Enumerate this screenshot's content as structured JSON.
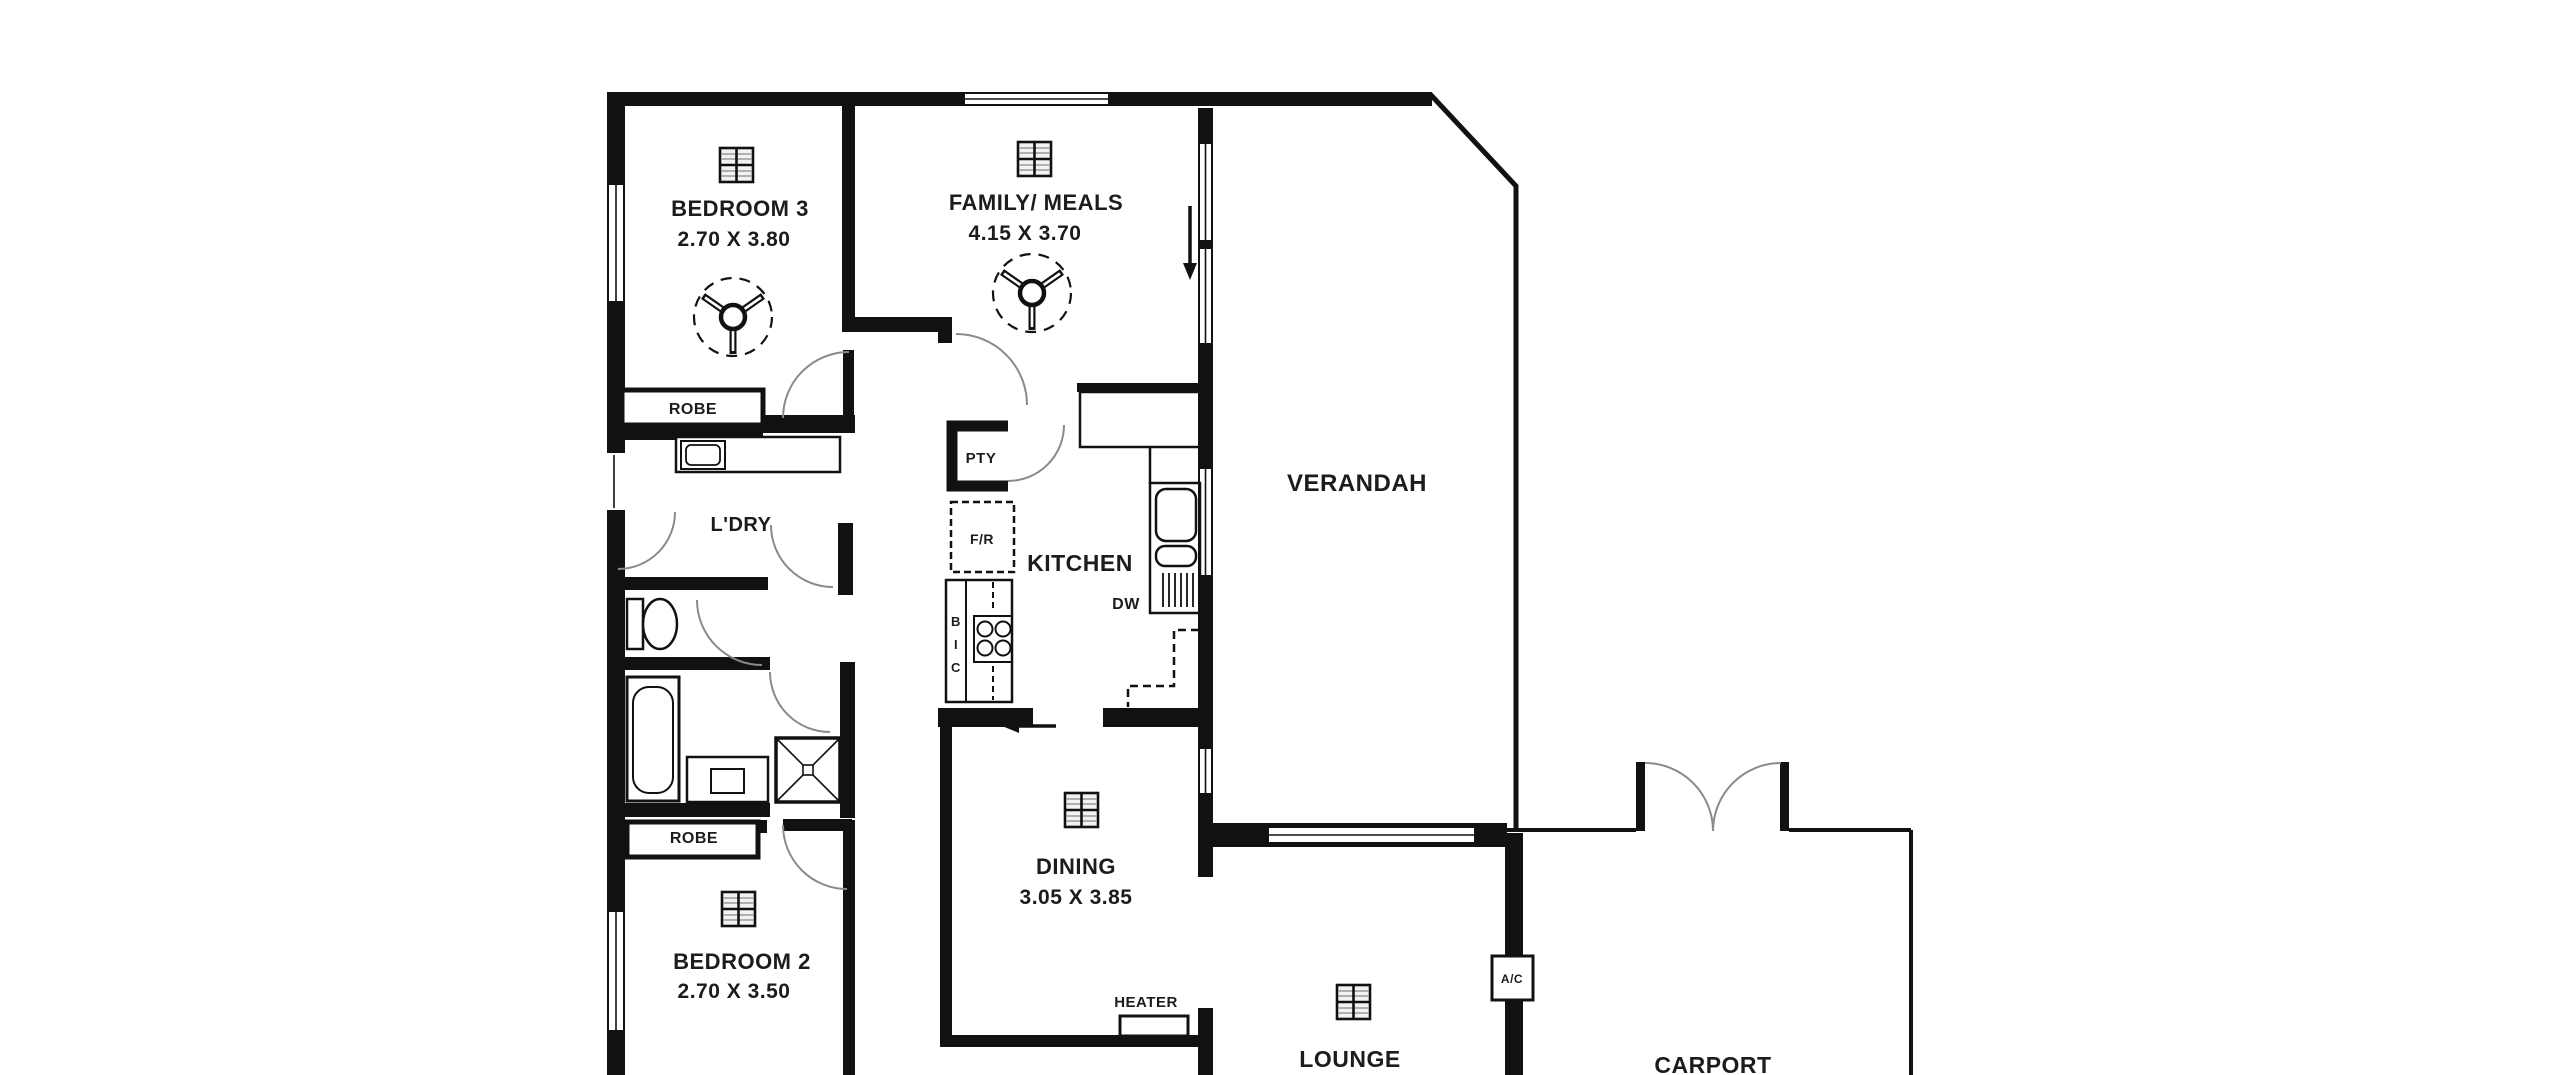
{
  "plan_title": "Residential floor plan",
  "rooms": {
    "bedroom3": {
      "name": "BEDROOM 3",
      "dims": "2.70 X 3.80"
    },
    "family_meals": {
      "name": "FAMILY/ MEALS",
      "dims": "4.15 X 3.70"
    },
    "verandah": {
      "name": "VERANDAH"
    },
    "laundry": {
      "name": "L'DRY"
    },
    "kitchen": {
      "name": "KITCHEN"
    },
    "dining": {
      "name": "DINING",
      "dims": "3.05 X 3.85"
    },
    "bedroom2": {
      "name": "BEDROOM 2",
      "dims": "2.70 X 3.50"
    },
    "lounge": {
      "name": "LOUNGE"
    },
    "carport": {
      "name": "CARPORT"
    }
  },
  "fixtures": {
    "robe_top": "ROBE",
    "robe_bottom": "ROBE",
    "pantry": "PTY",
    "fridge": "F/R",
    "bic": [
      "B",
      "I",
      "C"
    ],
    "dishwasher": "DW",
    "heater": "HEATER",
    "air_conditioner": "A/C"
  },
  "icons": {
    "ceiling_fan_count": 2,
    "ceiling_vent_count": 5,
    "names": [
      "ceiling-fan-icon",
      "heating-vent-icon",
      "down-arrow-icon",
      "left-arrow-icon"
    ]
  },
  "colors": {
    "wall": "#111111",
    "text": "#1c1c1c",
    "door_arc": "#8a8a8a",
    "background": "#ffffff"
  }
}
